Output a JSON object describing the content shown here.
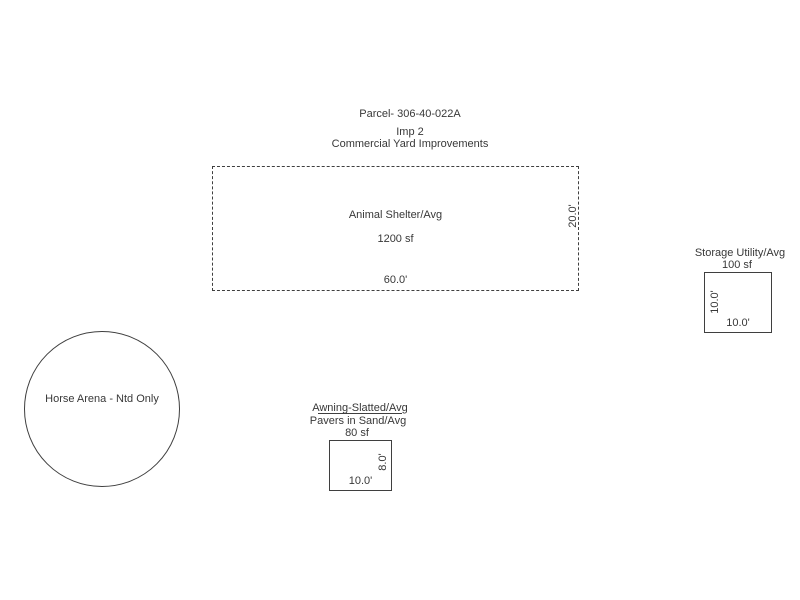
{
  "header": {
    "parcel_id": "Parcel- 306-40-022A",
    "improvement": "Imp 2",
    "title": "Commercial Yard Improvements"
  },
  "shapes": {
    "animal_shelter": {
      "label": "Animal Shelter/Avg",
      "area": "1200 sf",
      "bottom_dim": "60.0'",
      "side_dim": "20.0'"
    },
    "storage_utility": {
      "label": "Storage Utility/Avg",
      "area": "100 sf",
      "bottom_dim": "10.0'",
      "side_dim": "10.0'"
    },
    "horse_arena": {
      "label": "Horse Arena - Ntd Only"
    },
    "awning": {
      "label_top": "Awning-Slatted/Avg",
      "label_bottom": "Pavers in Sand/Avg",
      "area": "80 sf",
      "bottom_dim": "10.0'",
      "side_dim": "8.0'"
    }
  },
  "colors": {
    "line": "#3f3f3f",
    "text": "#383838",
    "background": "#ffffff"
  }
}
